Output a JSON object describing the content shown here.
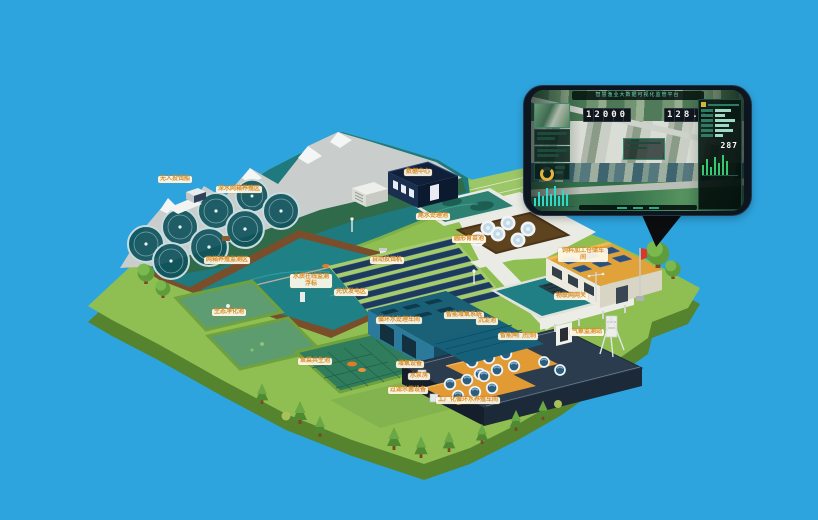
{
  "palette": {
    "background": "#2EA4DF",
    "label_text": "#D98E2B",
    "island_green": "#8FBF52",
    "lake_teal": "#1E7A7E",
    "pond_water": "#1F8086",
    "solar_blue": "#1C3A5E",
    "roof_teal": "#1A6076",
    "roof_yellow": "#E2A23A",
    "platform_navy": "#2A3C4E",
    "deck_orange": "#E29A35",
    "flag_red": "#D8372A"
  },
  "map": {
    "labels": [
      {
        "text": "无人投饵船"
      },
      {
        "text": "深水网箱养殖区"
      },
      {
        "text": "网箱养殖监测区"
      },
      {
        "text": "水质在线监测浮标"
      },
      {
        "text": "生态净化池"
      },
      {
        "text": "鱼菜共生池"
      },
      {
        "text": "光伏发电区"
      },
      {
        "text": "自动投饵机"
      },
      {
        "text": "数据中心"
      },
      {
        "text": "尾水处理池"
      },
      {
        "text": "圆形育苗池"
      },
      {
        "text": "循环水处理车间"
      },
      {
        "text": "智能增氧系统"
      },
      {
        "text": "智能闸门控制"
      },
      {
        "text": "工厂化循环水养殖车间"
      },
      {
        "text": "增氧设备"
      },
      {
        "text": "水泵房"
      },
      {
        "text": "过滤杀菌设备"
      },
      {
        "text": "饲料加工仓储车间"
      },
      {
        "text": "物联网网关"
      },
      {
        "text": "气象监测站"
      },
      {
        "text": "沉淀池"
      }
    ]
  },
  "phone": {
    "title": "智慧渔业大数据可视化监管平台",
    "counter_left": "12000",
    "counter_right": "128.5",
    "right_value": "287"
  }
}
